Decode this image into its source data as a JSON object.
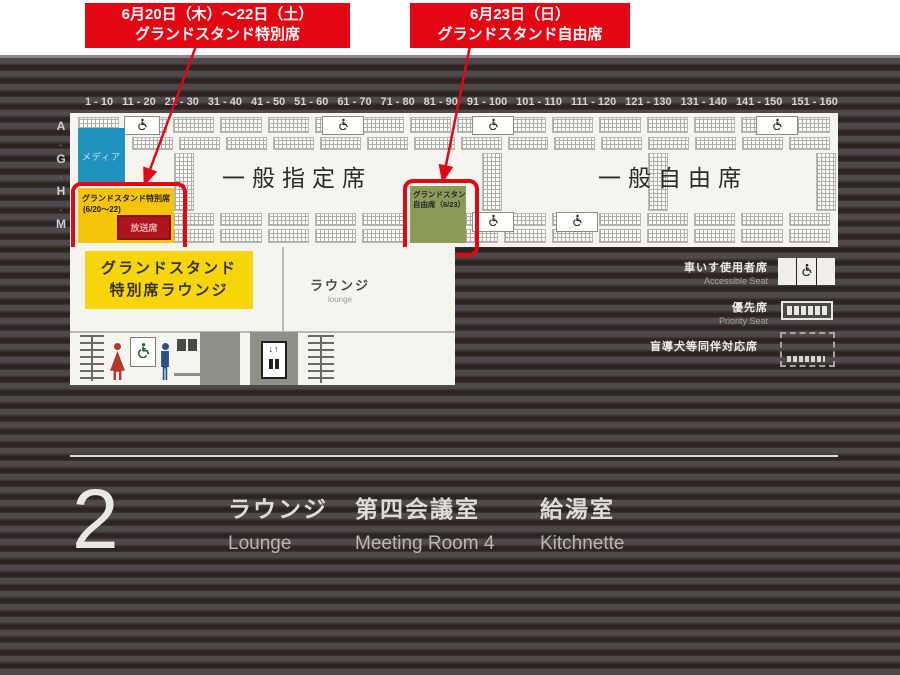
{
  "callouts": [
    {
      "line1": "6月20日（木）～22日（土）",
      "line2": "グランドスタンド特別席"
    },
    {
      "line1": "6月23日（日）",
      "line2": "グランドスタンド自由席"
    }
  ],
  "map": {
    "seat_ranges": [
      "1 - 10",
      "11 - 20",
      "21 - 30",
      "31 - 40",
      "41 - 50",
      "51 - 60",
      "61 - 70",
      "71 - 80",
      "81 - 90",
      "91 - 100",
      "101 - 110",
      "111 - 120",
      "121 - 130",
      "131 - 140",
      "141 - 150",
      "151 - 160"
    ],
    "row_letters": [
      "A",
      "G",
      "H",
      "M"
    ],
    "areas": {
      "media": "メディア",
      "general_reserved": "一般指定席",
      "general_free": "一般自由席",
      "grandstand_special": {
        "line1": "グランドスタンド特別席",
        "line2": "(6/20～22)",
        "sub": "放送席"
      },
      "grandstand_free": {
        "line1": "グランドスタンド",
        "line2": "自由席（6/23）"
      },
      "special_lounge": {
        "line1": "グランドスタンド",
        "line2": "特別席ラウンジ"
      },
      "lounge_room": {
        "jp": "ラウンジ",
        "en": "lounge"
      }
    },
    "legend": [
      {
        "jp": "車いす使用者席",
        "en": "Accessible Seat"
      },
      {
        "jp": "優先席",
        "en": "Priority Seat"
      },
      {
        "jp": "盲導犬等同伴対応席",
        "en": ""
      }
    ]
  },
  "floor": {
    "number": "2",
    "rooms": [
      {
        "jp": "ラウンジ",
        "en": "Lounge"
      },
      {
        "jp": "第四会議室",
        "en": "Meeting Room 4"
      },
      {
        "jp": "給湯室",
        "en": "Kitchnette"
      }
    ]
  },
  "misc": {
    "elevator_arrows": "↓↑"
  },
  "colors": {
    "accent_red": "#e30613",
    "highlight_yellow": "#f4c50c",
    "lounge_yellow": "#f6d50a",
    "olive_green": "#8d9b59",
    "media_blue": "#2191bd",
    "broadcast_red": "#ad141d",
    "stripe_dark": "#2d2422",
    "stripe_light": "#4e4a4c"
  }
}
